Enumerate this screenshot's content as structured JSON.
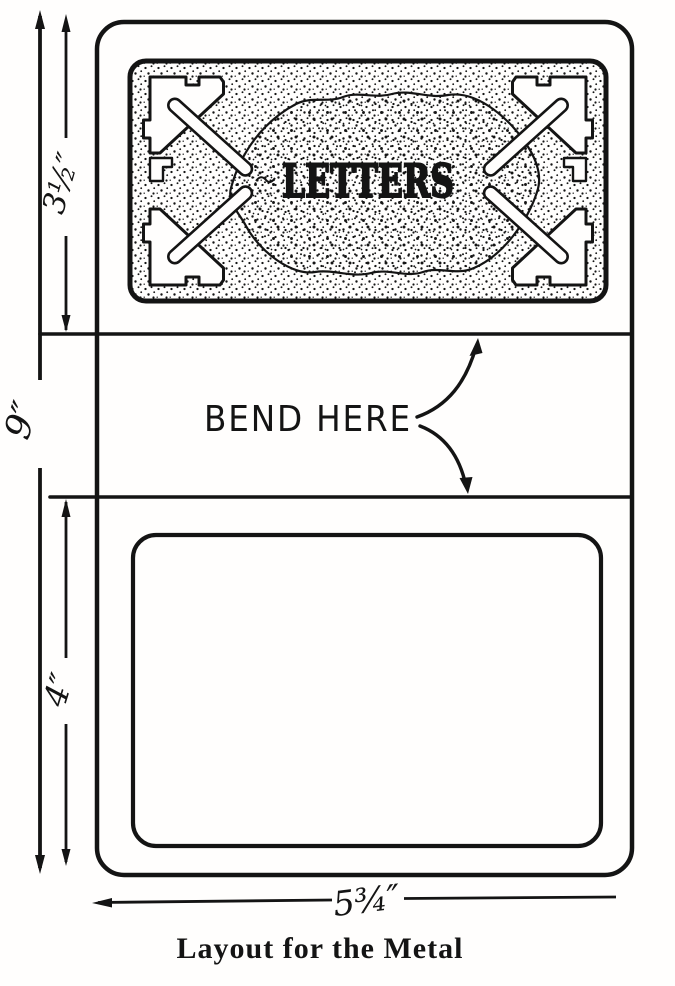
{
  "figure": {
    "type": "technical-drawing",
    "caption": "Layout for the Metal",
    "panel": {
      "embossed_text": "LETTERS",
      "style": "stippled ornamental plate with corner scrolls"
    },
    "bend_annotation": {
      "label": "BEND HERE"
    },
    "dimensions": {
      "top_section_height": "3½″",
      "total_height": "9″",
      "bottom_section_height": "4″",
      "overall_width": "5¾″"
    },
    "colors": {
      "ink": "#141414",
      "paper": "#fffefd"
    }
  }
}
